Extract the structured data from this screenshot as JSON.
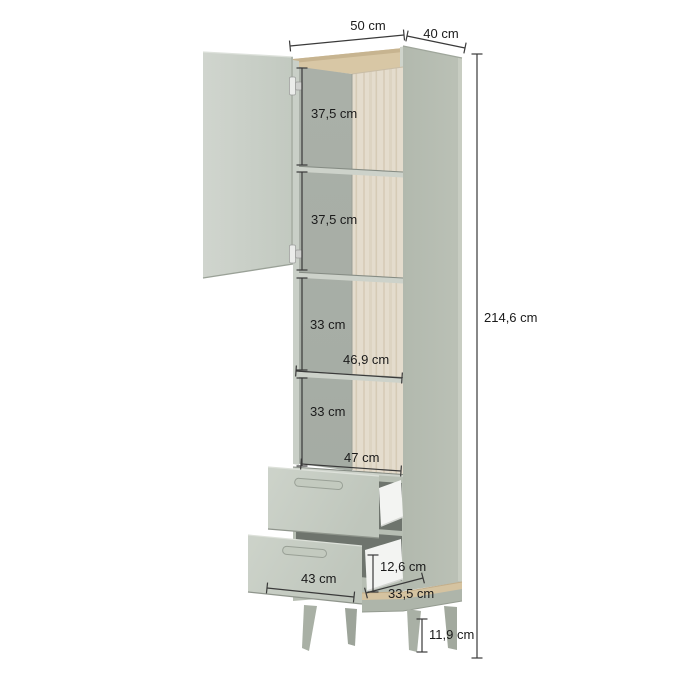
{
  "diagram": {
    "product": "tall storage cabinet with open left door, four interior shelves and two open drawers on tapered legs",
    "unit": "cm",
    "labels": {
      "top_width": "50 cm",
      "top_depth": "40 cm",
      "section1": "37,5 cm",
      "section2": "37,5 cm",
      "section3": "33 cm",
      "interior_width": "46,9 cm",
      "section4": "33 cm",
      "bottom_interior_width": "47 cm",
      "total_height": "214,6 cm",
      "drawer_front_width": "43 cm",
      "drawer_inner_height": "12,6 cm",
      "drawer_depth": "33,5 cm",
      "leg_height": "11,9 cm"
    },
    "colors": {
      "background": "#ffffff",
      "body_sage": "#b7beb3",
      "door_sage": "#c7cdc5",
      "wood_top": "#d8c7a5",
      "wood_edge": "#c7b490",
      "back_panel_wood": "#e4dccd",
      "interior_gray": "#a9afa7",
      "shelf_face": "#cdd2ca",
      "opening_dark": "#6e746d",
      "drawer_box_white": "#f3f4f2",
      "leg_sage": "#a9b0a5",
      "dimension_line": "#3a3a3a",
      "text": "#1b1b1b"
    }
  }
}
